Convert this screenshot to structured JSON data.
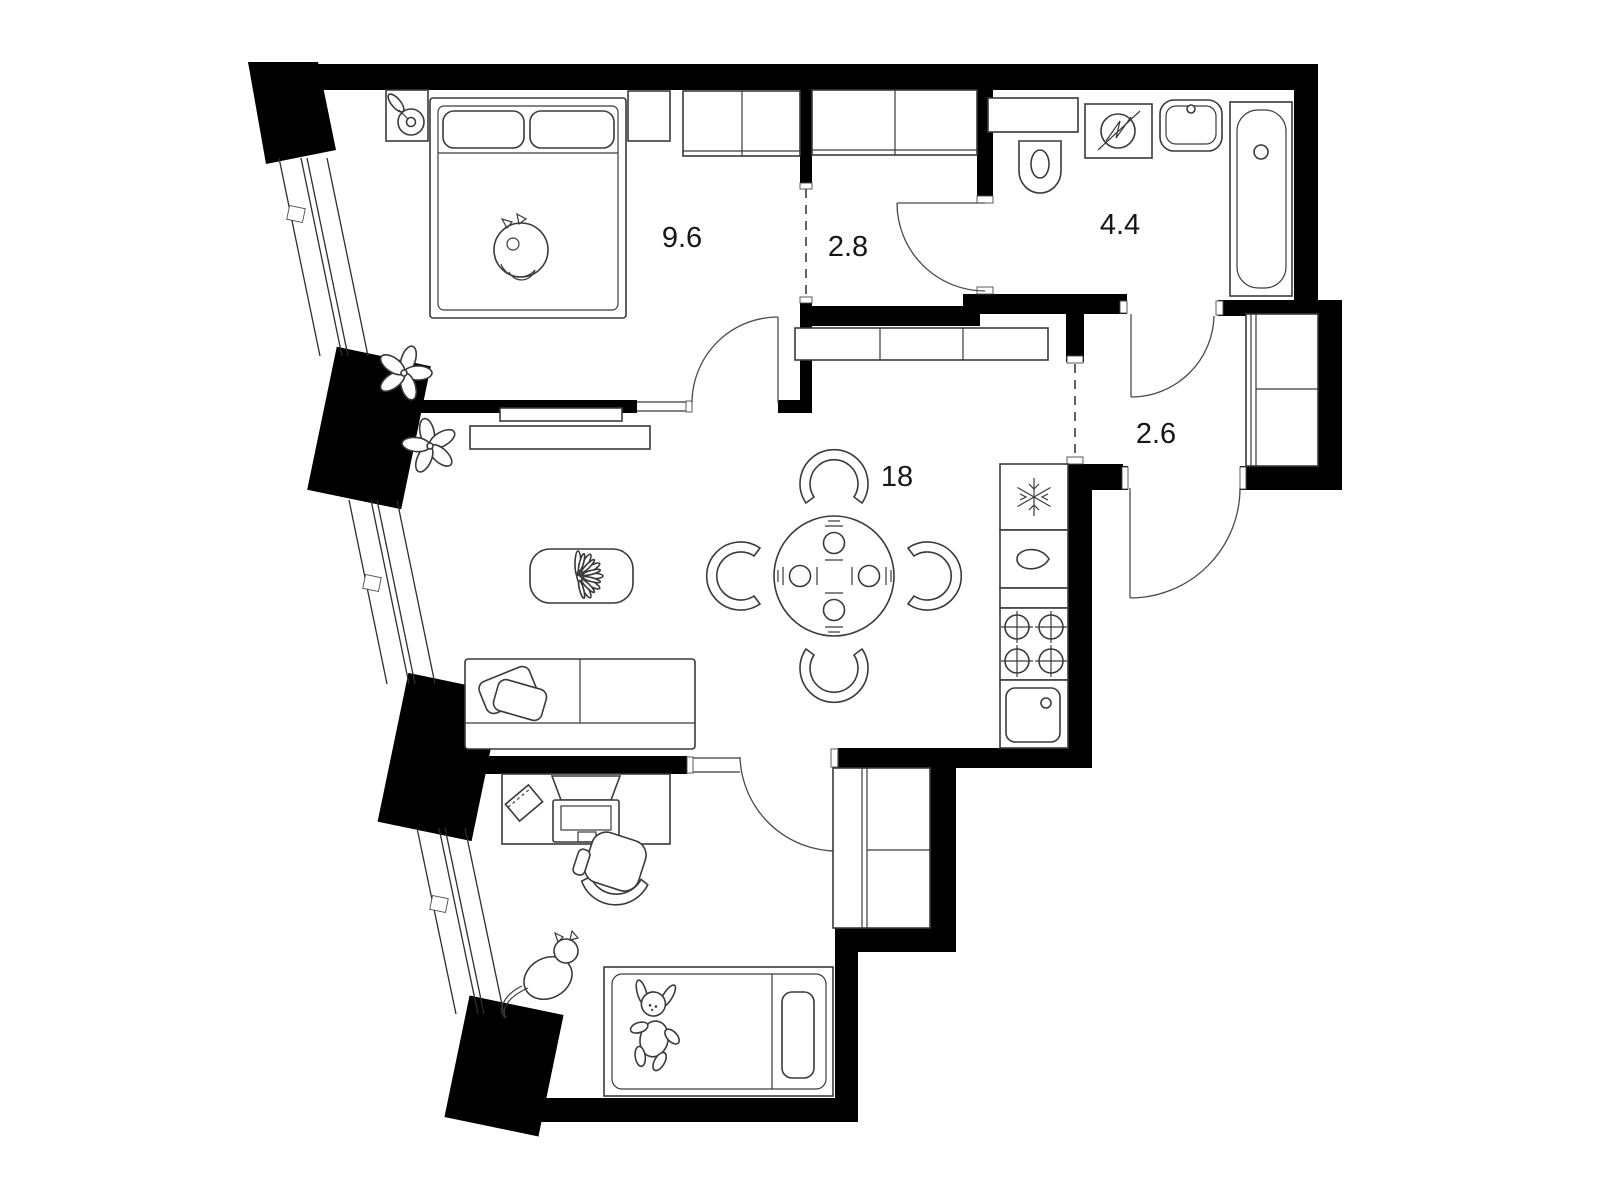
{
  "plan": {
    "type": "apartment-floor-plan",
    "colors": {
      "background": "#ffffff",
      "wall": "#000000",
      "furniture_line": "#3a3a3a"
    },
    "rooms": [
      {
        "name": "bedroom",
        "area_label": "9.6"
      },
      {
        "name": "inner-hallway",
        "area_label": "2.8"
      },
      {
        "name": "bathroom",
        "area_label": "4.4"
      },
      {
        "name": "entry-hall",
        "area_label": "2.6"
      },
      {
        "name": "living-dining-kitchen",
        "area_label": "18"
      }
    ],
    "fixtures": [
      "double-bed-icon",
      "sleeping-cat-icon",
      "nightstand-icon",
      "bedroom-wardrobe-icon",
      "plant-icon",
      "tv-icon",
      "tv-console-icon",
      "coffee-table-icon",
      "sofa-icon",
      "pillow-icon",
      "dining-table-icon",
      "dining-chair-icon",
      "place-setting-icon",
      "hallway-wardrobe-icon",
      "entry-wardrobe-icon",
      "duct-niche-icon",
      "toilet-icon",
      "washing-machine-icon",
      "bathroom-sink-icon",
      "bathtub-icon",
      "fridge-icon",
      "kitchen-cabinet-icon",
      "stove-icon",
      "kitchen-sink-icon",
      "desk-icon",
      "laptop-icon",
      "notebook-icon",
      "office-chair-icon",
      "standing-cat-icon",
      "child-bed-icon",
      "bunny-toy-icon",
      "child-wardrobe-icon",
      "door-arc",
      "window-band",
      "zone-dashed-line"
    ]
  }
}
